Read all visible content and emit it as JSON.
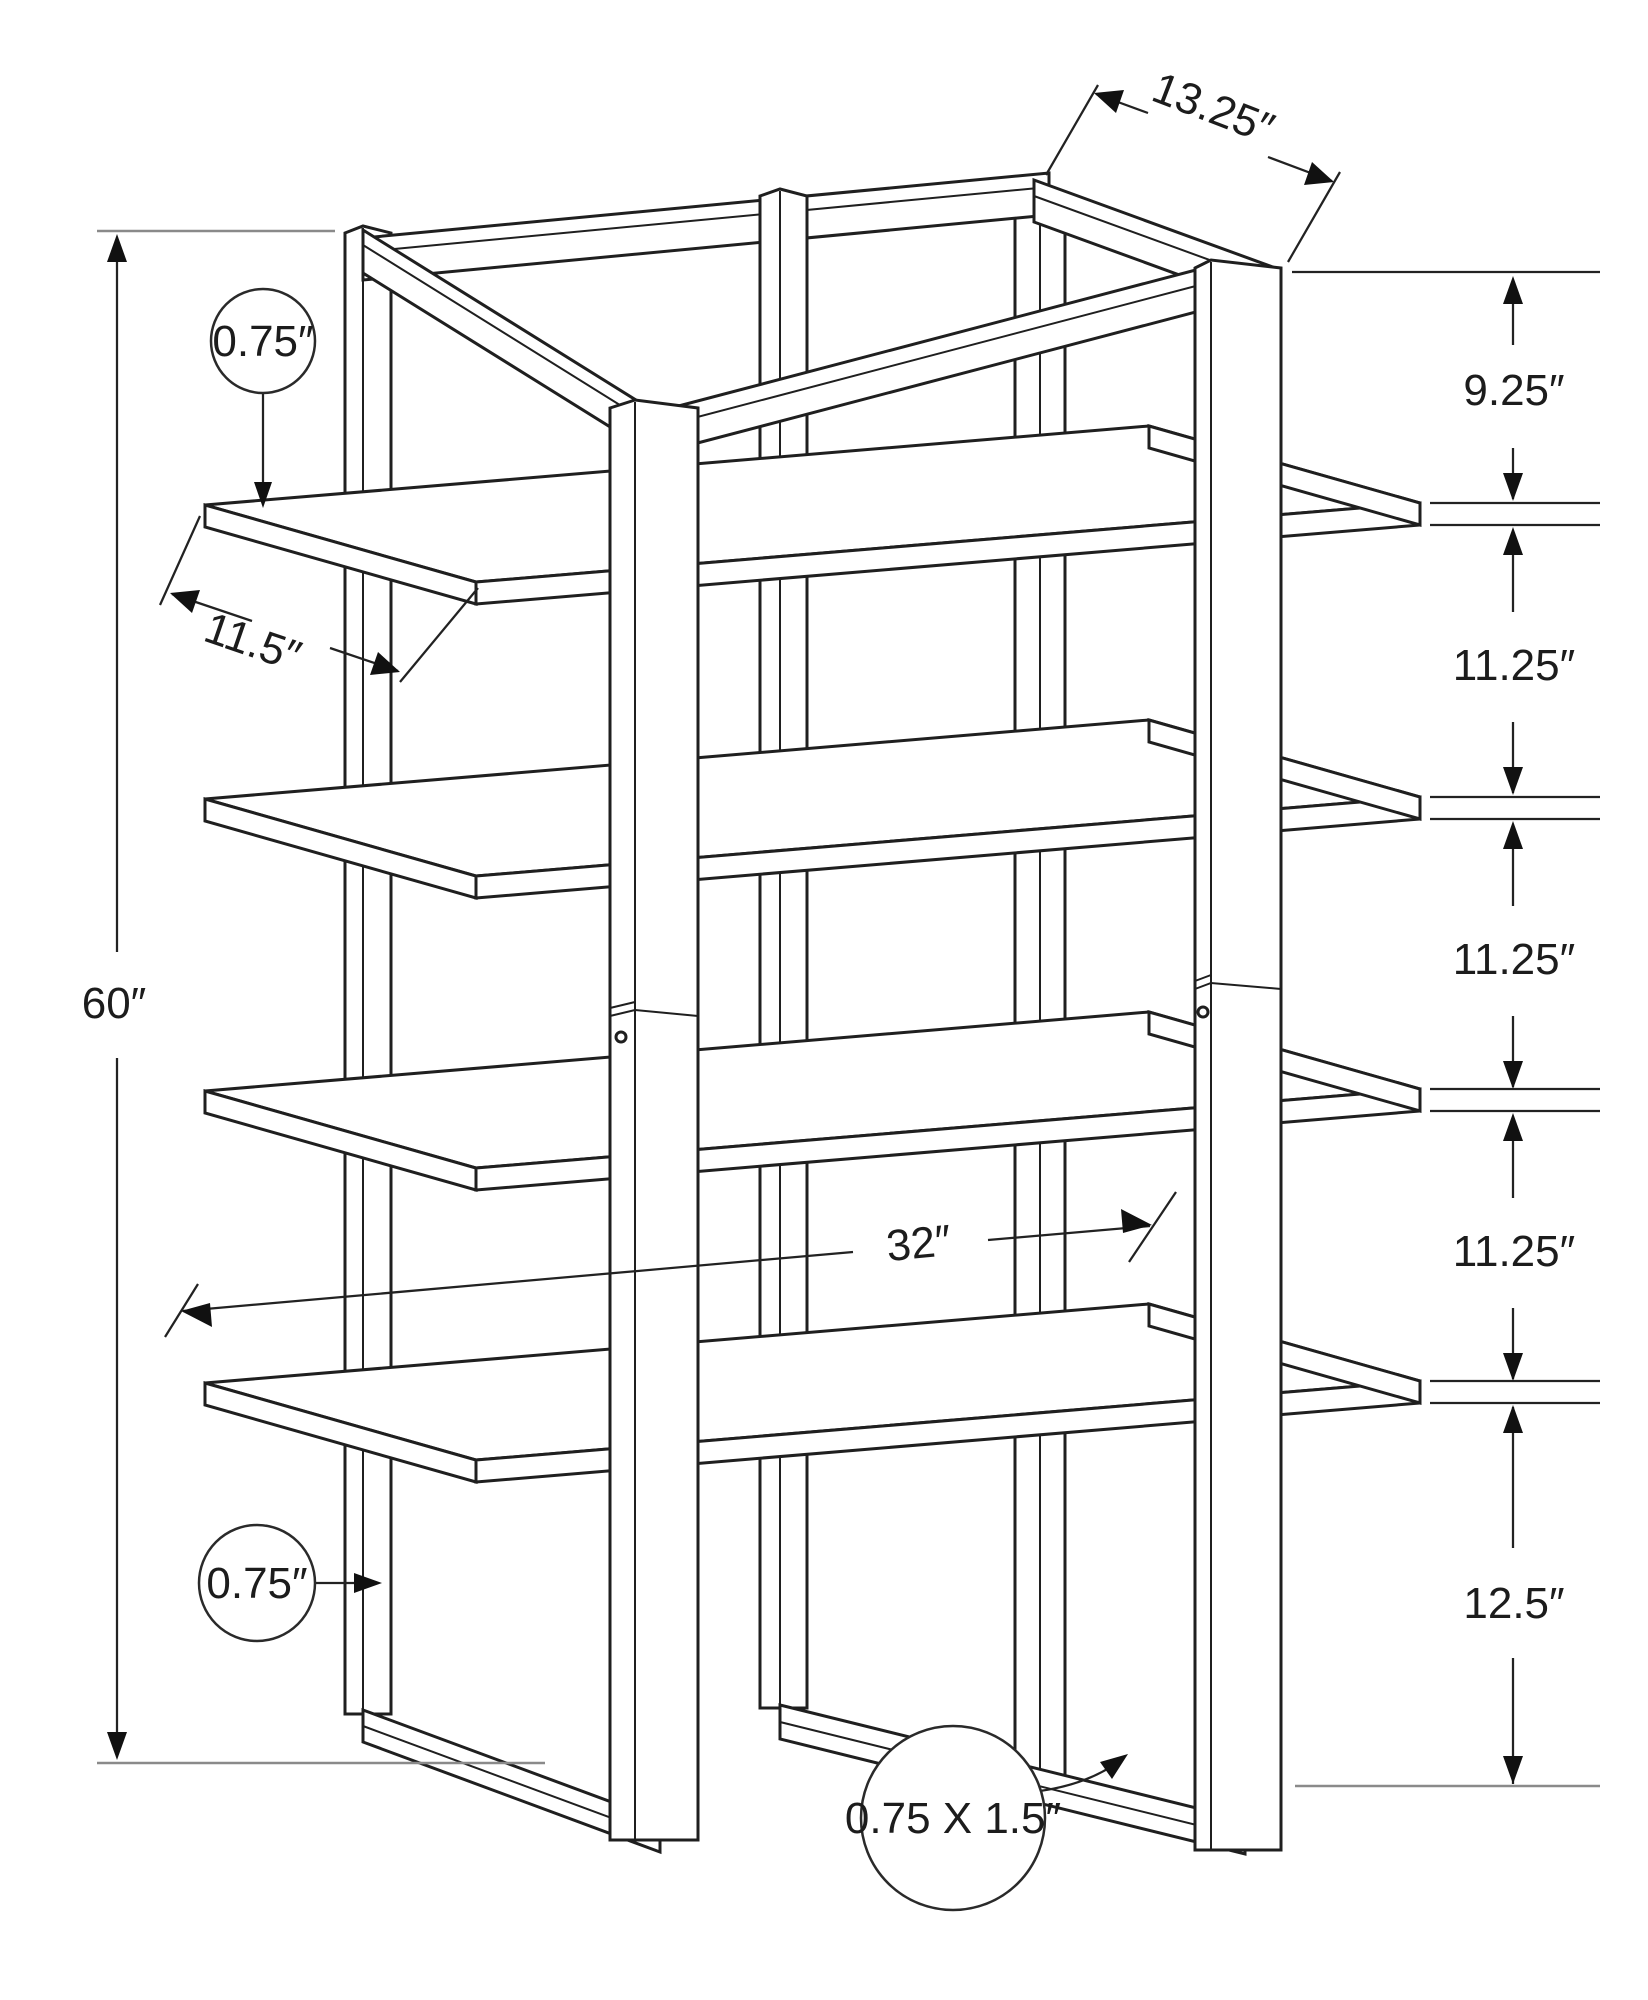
{
  "diagram": {
    "title": "5-tier etagere bookcase dimension drawing",
    "units": "inches",
    "annotations": {
      "total_height": "60″",
      "top_frame_depth": "13.25″",
      "shelf_depth": "11.5″",
      "shelf_width": "32″",
      "shelf_thickness": "0.75″",
      "post_thickness": "0.75″",
      "base_rail_section": "0.75 X 1.5″",
      "gap_top": "9.25″",
      "gap_1": "11.25″",
      "gap_2": "11.25″",
      "gap_3": "11.25″",
      "gap_bottom": "12.5″"
    },
    "line_color": "#1f1f1f",
    "background": "#ffffff"
  }
}
